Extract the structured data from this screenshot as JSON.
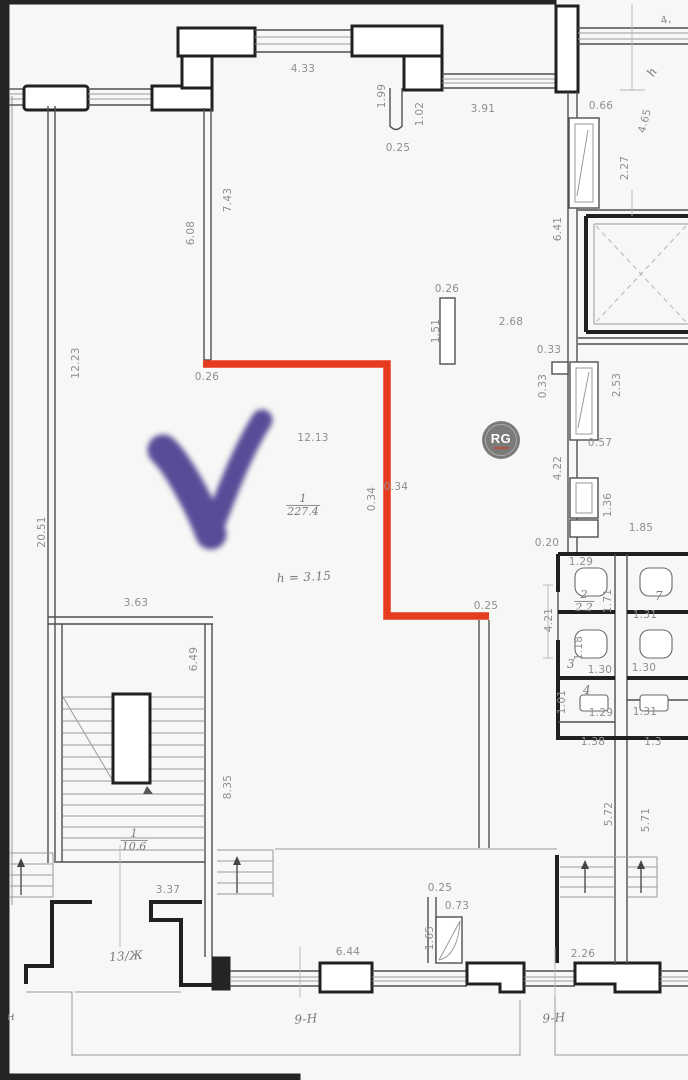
{
  "title": "apartment-floor-plan",
  "annotations": {
    "highlight_path_color": "#e63b1e",
    "checkmark_color": "#4b4191",
    "watermark": {
      "text": "RG",
      "circle_color": "#696969",
      "accent_color": "#a83c30"
    }
  },
  "rooms": {
    "main_room": {
      "number": "1",
      "area": "227.4",
      "height_note": "h = 3.15"
    },
    "stair_room": {
      "number": "1",
      "area": "10.6"
    },
    "wc_room": {
      "number": "2",
      "area": "2.2"
    },
    "unit_label": "13/Ж",
    "zone_labels": [
      "9-Н",
      "9-Н"
    ]
  },
  "plan": {
    "fractions": [
      {
        "num": "1",
        "den": "227.4",
        "x": 303,
        "y": 505
      },
      {
        "num": "2",
        "den": "2.2",
        "x": 584,
        "y": 601
      },
      {
        "num": "1",
        "den": "10.6",
        "x": 134,
        "y": 840
      }
    ],
    "labels": [
      {
        "t": "4.33",
        "x": 303,
        "y": 69,
        "r": 0,
        "s": "d"
      },
      {
        "t": "1.99",
        "x": 382,
        "y": 96,
        "r": -90,
        "s": "d"
      },
      {
        "t": "1.02",
        "x": 420,
        "y": 114,
        "r": -90,
        "s": "d"
      },
      {
        "t": "0.25",
        "x": 398,
        "y": 148,
        "r": 0,
        "s": "d"
      },
      {
        "t": "3.91",
        "x": 483,
        "y": 109,
        "r": 0,
        "s": "d"
      },
      {
        "t": "0.66",
        "x": 601,
        "y": 106,
        "r": 0,
        "s": "d"
      },
      {
        "t": "4.65",
        "x": 645,
        "y": 121,
        "r": -75,
        "s": "d"
      },
      {
        "t": "h",
        "x": 652,
        "y": 72,
        "r": -60,
        "s": "h"
      },
      {
        "t": "4,",
        "x": 666,
        "y": 20,
        "r": -15,
        "s": "d"
      },
      {
        "t": "2.27",
        "x": 625,
        "y": 168,
        "r": -90,
        "s": "d"
      },
      {
        "t": "6.41",
        "x": 558,
        "y": 229,
        "r": -90,
        "s": "d"
      },
      {
        "t": "7.43",
        "x": 228,
        "y": 200,
        "r": -90,
        "s": "d"
      },
      {
        "t": "6.08",
        "x": 191,
        "y": 233,
        "r": -90,
        "s": "d"
      },
      {
        "t": "12.23",
        "x": 76,
        "y": 363,
        "r": -90,
        "s": "d"
      },
      {
        "t": "0.26",
        "x": 207,
        "y": 377,
        "r": 0,
        "s": "d"
      },
      {
        "t": "2.68",
        "x": 511,
        "y": 322,
        "r": 0,
        "s": "d"
      },
      {
        "t": "0.26",
        "x": 447,
        "y": 289,
        "r": 0,
        "s": "d"
      },
      {
        "t": "1.51",
        "x": 436,
        "y": 331,
        "r": -90,
        "s": "d"
      },
      {
        "t": "0.33",
        "x": 549,
        "y": 350,
        "r": 0,
        "s": "d"
      },
      {
        "t": "0.33",
        "x": 543,
        "y": 386,
        "r": -90,
        "s": "d"
      },
      {
        "t": "2.53",
        "x": 617,
        "y": 385,
        "r": -90,
        "s": "d"
      },
      {
        "t": "0.57",
        "x": 600,
        "y": 443,
        "r": 0,
        "s": "d"
      },
      {
        "t": "4.22",
        "x": 558,
        "y": 468,
        "r": -90,
        "s": "d"
      },
      {
        "t": "1.36",
        "x": 608,
        "y": 505,
        "r": -90,
        "s": "d"
      },
      {
        "t": "1.85",
        "x": 641,
        "y": 528,
        "r": 0,
        "s": "d"
      },
      {
        "t": "0.20",
        "x": 547,
        "y": 543,
        "r": 0,
        "s": "d"
      },
      {
        "t": "12.13",
        "x": 313,
        "y": 438,
        "r": 0,
        "s": "d"
      },
      {
        "t": "0.34",
        "x": 372,
        "y": 499,
        "r": -90,
        "s": "d"
      },
      {
        "t": "0.34",
        "x": 396,
        "y": 487,
        "r": 0,
        "s": "d"
      },
      {
        "t": "20.51",
        "x": 42,
        "y": 532,
        "r": -90,
        "s": "d"
      },
      {
        "t": "3.63",
        "x": 136,
        "y": 603,
        "r": 0,
        "s": "d"
      },
      {
        "t": "0.25",
        "x": 486,
        "y": 606,
        "r": 0,
        "s": "d"
      },
      {
        "t": "6.49",
        "x": 194,
        "y": 659,
        "r": -90,
        "s": "d"
      },
      {
        "t": "8.35",
        "x": 228,
        "y": 787,
        "r": -90,
        "s": "d"
      },
      {
        "t": "1.29",
        "x": 581,
        "y": 562,
        "r": 0,
        "s": "d"
      },
      {
        "t": "1.71",
        "x": 608,
        "y": 601,
        "r": -90,
        "s": "d"
      },
      {
        "t": "1.31",
        "x": 645,
        "y": 615,
        "r": 0,
        "s": "d"
      },
      {
        "t": "7",
        "x": 659,
        "y": 596,
        "r": 0,
        "s": "h"
      },
      {
        "t": "4.21",
        "x": 549,
        "y": 620,
        "r": -90,
        "s": "d"
      },
      {
        "t": "1.18",
        "x": 579,
        "y": 648,
        "r": -90,
        "s": "d"
      },
      {
        "t": "3",
        "x": 571,
        "y": 664,
        "r": 0,
        "s": "h"
      },
      {
        "t": "1.30",
        "x": 600,
        "y": 670,
        "r": 0,
        "s": "d"
      },
      {
        "t": "1.30",
        "x": 644,
        "y": 668,
        "r": 0,
        "s": "d"
      },
      {
        "t": "1.01",
        "x": 562,
        "y": 702,
        "r": -90,
        "s": "d"
      },
      {
        "t": "4",
        "x": 587,
        "y": 690,
        "r": 0,
        "s": "h"
      },
      {
        "t": "1.29",
        "x": 601,
        "y": 713,
        "r": 0,
        "s": "d"
      },
      {
        "t": "1.31",
        "x": 645,
        "y": 712,
        "r": 0,
        "s": "d"
      },
      {
        "t": "1.38",
        "x": 593,
        "y": 742,
        "r": 0,
        "s": "d"
      },
      {
        "t": "1.3",
        "x": 653,
        "y": 742,
        "r": 0,
        "s": "d"
      },
      {
        "t": "5.72",
        "x": 609,
        "y": 814,
        "r": -90,
        "s": "d"
      },
      {
        "t": "5.71",
        "x": 646,
        "y": 820,
        "r": -90,
        "s": "d"
      },
      {
        "t": "3.37",
        "x": 168,
        "y": 890,
        "r": 0,
        "s": "d"
      },
      {
        "t": "0.25",
        "x": 440,
        "y": 888,
        "r": 0,
        "s": "d"
      },
      {
        "t": "0.73",
        "x": 457,
        "y": 906,
        "r": 0,
        "s": "d"
      },
      {
        "t": "1.65",
        "x": 430,
        "y": 938,
        "r": -90,
        "s": "d"
      },
      {
        "t": "6.44",
        "x": 348,
        "y": 952,
        "r": 0,
        "s": "d"
      },
      {
        "t": "2.26",
        "x": 583,
        "y": 954,
        "r": 0,
        "s": "d"
      },
      {
        "t": "h = 3.15",
        "x": 304,
        "y": 577,
        "r": -3,
        "s": "h"
      },
      {
        "t": "13/Ж",
        "x": 126,
        "y": 956,
        "r": -4,
        "s": "h"
      },
      {
        "t": "9-Н",
        "x": 306,
        "y": 1019,
        "r": -4,
        "s": "h"
      },
      {
        "t": "9-Н",
        "x": 554,
        "y": 1018,
        "r": -4,
        "s": "h"
      },
      {
        "t": "н",
        "x": 11,
        "y": 1016,
        "r": -4,
        "s": "h"
      }
    ]
  }
}
